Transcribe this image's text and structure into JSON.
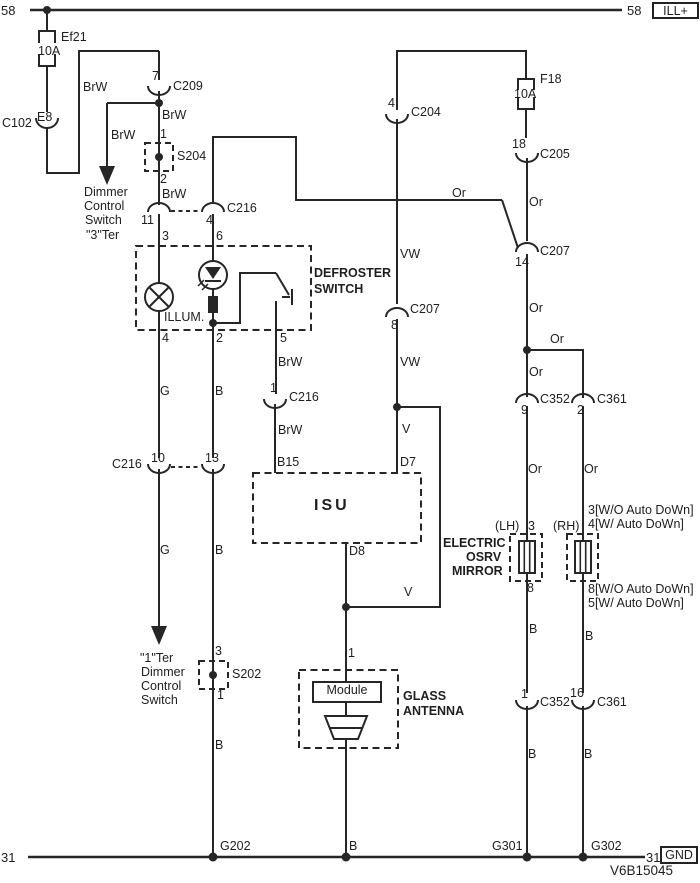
{
  "colors": {
    "line": "#262626",
    "text": "#1e1e1e",
    "background": "#ffffff"
  },
  "rails": {
    "top": {
      "left": "58",
      "right": "58",
      "tag": "ILL+"
    },
    "bottom": {
      "left": "31",
      "right": "31",
      "tag": "GND"
    }
  },
  "code": "V6B15045",
  "labels": [
    {
      "name": "fuse-ef21-name",
      "text": "Ef21",
      "x": 61,
      "y": 31
    },
    {
      "name": "fuse-ef21-rating",
      "text": "10A",
      "x": 38,
      "y": 45
    },
    {
      "name": "connector-c102-name",
      "text": "C102",
      "x": 2,
      "y": 117
    },
    {
      "name": "connector-c102-pin-e8",
      "text": "E8",
      "x": 37,
      "y": 111
    },
    {
      "name": "wire-brw-feed",
      "text": "BrW",
      "x": 83,
      "y": 81
    },
    {
      "name": "connector-c209-pin-7",
      "text": "7",
      "x": 152,
      "y": 70
    },
    {
      "name": "connector-c209-name",
      "text": "C209",
      "x": 173,
      "y": 80
    },
    {
      "name": "wire-brw-below-c209",
      "text": "BrW",
      "x": 162,
      "y": 109
    },
    {
      "name": "wire-brw-dimmer-branch",
      "text": "BrW",
      "x": 111,
      "y": 129
    },
    {
      "name": "splice-s204-pin-1",
      "text": "1",
      "x": 160,
      "y": 128
    },
    {
      "name": "splice-s204-name",
      "text": "S204",
      "x": 177,
      "y": 150
    },
    {
      "name": "splice-s204-pin-2",
      "text": "2",
      "x": 160,
      "y": 173
    },
    {
      "name": "wire-brw-above-c216",
      "text": "BrW",
      "x": 162,
      "y": 188
    },
    {
      "name": "dimmer-note-line-1",
      "text": "Dimmer",
      "x": 84,
      "y": 186
    },
    {
      "name": "dimmer-note-line-2",
      "text": "Control",
      "x": 84,
      "y": 200
    },
    {
      "name": "dimmer-note-line-3",
      "text": "Switch",
      "x": 85,
      "y": 214
    },
    {
      "name": "dimmer-note-line-4",
      "text": "\"3\"Ter",
      "x": 86,
      "y": 229
    },
    {
      "name": "connector-c216-top-pin-11",
      "text": "11",
      "x": 141,
      "y": 214
    },
    {
      "name": "connector-c216-top-pin-4",
      "text": "4",
      "x": 206,
      "y": 214
    },
    {
      "name": "connector-c216-top-name",
      "text": "C216",
      "x": 227,
      "y": 202
    },
    {
      "name": "defroster-pin-3",
      "text": "3",
      "x": 162,
      "y": 230
    },
    {
      "name": "defroster-pin-6",
      "text": "6",
      "x": 216,
      "y": 230
    },
    {
      "name": "defroster-name-line-1",
      "text": "DEFROSTER",
      "x": 314,
      "y": 267,
      "bold": true
    },
    {
      "name": "defroster-name-line-2",
      "text": "SWITCH",
      "x": 314,
      "y": 283,
      "bold": true
    },
    {
      "name": "defroster-illum-label",
      "text": "ILLUM.",
      "x": 164,
      "y": 311
    },
    {
      "name": "defroster-pin-4",
      "text": "4",
      "x": 162,
      "y": 332
    },
    {
      "name": "defroster-pin-2",
      "text": "2",
      "x": 216,
      "y": 332
    },
    {
      "name": "defroster-pin-5",
      "text": "5",
      "x": 280,
      "y": 332
    },
    {
      "name": "wire-g-upper",
      "text": "G",
      "x": 160,
      "y": 385
    },
    {
      "name": "wire-b-upper",
      "text": "B",
      "x": 215,
      "y": 385
    },
    {
      "name": "wire-brw-pin5",
      "text": "BrW",
      "x": 278,
      "y": 356
    },
    {
      "name": "connector-c216-mid-right-pin-1",
      "text": "1",
      "x": 270,
      "y": 382
    },
    {
      "name": "connector-c216-mid-right-name",
      "text": "C216",
      "x": 289,
      "y": 391
    },
    {
      "name": "wire-brw-to-isu",
      "text": "BrW",
      "x": 278,
      "y": 424
    },
    {
      "name": "isu-pin-b15",
      "text": "B15",
      "x": 277,
      "y": 456
    },
    {
      "name": "isu-pin-d7",
      "text": "D7",
      "x": 400,
      "y": 456
    },
    {
      "name": "wire-v-to-isu",
      "text": "V",
      "x": 402,
      "y": 423
    },
    {
      "name": "connector-c204-pin-4",
      "text": "4",
      "x": 388,
      "y": 97
    },
    {
      "name": "connector-c204-name",
      "text": "C204",
      "x": 411,
      "y": 106
    },
    {
      "name": "wire-vw-upper",
      "text": "VW",
      "x": 400,
      "y": 248
    },
    {
      "name": "connector-c207-mid-pin-8",
      "text": "8",
      "x": 391,
      "y": 319
    },
    {
      "name": "connector-c207-mid-name",
      "text": "C207",
      "x": 410,
      "y": 303
    },
    {
      "name": "wire-vw-lower",
      "text": "VW",
      "x": 400,
      "y": 356
    },
    {
      "name": "wire-or-top",
      "text": "Or",
      "x": 452,
      "y": 187
    },
    {
      "name": "fuse-f18-name",
      "text": "F18",
      "x": 540,
      "y": 73
    },
    {
      "name": "fuse-f18-rating",
      "text": "10A",
      "x": 514,
      "y": 88
    },
    {
      "name": "connector-c205-pin-18",
      "text": "18",
      "x": 512,
      "y": 138
    },
    {
      "name": "connector-c205-name",
      "text": "C205",
      "x": 540,
      "y": 148
    },
    {
      "name": "wire-or-above-c207",
      "text": "Or",
      "x": 529,
      "y": 196
    },
    {
      "name": "connector-c207-right-pin-14",
      "text": "14",
      "x": 515,
      "y": 256
    },
    {
      "name": "connector-c207-right-name",
      "text": "C207",
      "x": 540,
      "y": 245
    },
    {
      "name": "wire-or-below-c207",
      "text": "Or",
      "x": 529,
      "y": 302
    },
    {
      "name": "wire-or-branch",
      "text": "Or",
      "x": 550,
      "y": 333
    },
    {
      "name": "wire-or-above-c352",
      "text": "Or",
      "x": 529,
      "y": 366
    },
    {
      "name": "connector-c352-top-pin-9",
      "text": "9",
      "x": 521,
      "y": 404
    },
    {
      "name": "connector-c352-top-name",
      "text": "C352",
      "x": 540,
      "y": 393
    },
    {
      "name": "connector-c361-top-pin-2",
      "text": "2",
      "x": 577,
      "y": 404
    },
    {
      "name": "connector-c361-top-name",
      "text": "C361",
      "x": 597,
      "y": 393
    },
    {
      "name": "wire-or-lh",
      "text": "Or",
      "x": 528,
      "y": 463
    },
    {
      "name": "wire-or-rh",
      "text": "Or",
      "x": 584,
      "y": 463
    },
    {
      "name": "mirror-rh-note-line-1",
      "text": "3[W/O Auto DoWn]",
      "x": 588,
      "y": 504
    },
    {
      "name": "mirror-rh-note-line-2",
      "text": "4[W/ Auto DoWn]",
      "x": 588,
      "y": 518
    },
    {
      "name": "mirror-lh-tag",
      "text": "(LH)",
      "x": 495,
      "y": 520
    },
    {
      "name": "mirror-lh-pin-3",
      "text": "3",
      "x": 528,
      "y": 520
    },
    {
      "name": "mirror-rh-tag",
      "text": "(RH)",
      "x": 553,
      "y": 520
    },
    {
      "name": "mirror-name-line-1",
      "text": "ELECTRIC",
      "x": 443,
      "y": 537,
      "bold": true
    },
    {
      "name": "mirror-name-line-2",
      "text": "OSRV",
      "x": 466,
      "y": 551,
      "bold": true
    },
    {
      "name": "mirror-name-line-3",
      "text": "MIRROR",
      "x": 452,
      "y": 565,
      "bold": true
    },
    {
      "name": "mirror-lh-pin-8",
      "text": "8",
      "x": 527,
      "y": 582
    },
    {
      "name": "mirror-rh-note-line-3",
      "text": "8[W/O Auto DoWn]",
      "x": 588,
      "y": 583
    },
    {
      "name": "mirror-rh-note-line-4",
      "text": "5[W/ Auto DoWn]",
      "x": 588,
      "y": 597
    },
    {
      "name": "wire-b-lh-upper",
      "text": "B",
      "x": 529,
      "y": 623
    },
    {
      "name": "wire-b-rh-upper",
      "text": "B",
      "x": 585,
      "y": 630
    },
    {
      "name": "isu-name",
      "text": "ISU",
      "x": 314,
      "y": 498,
      "bold": true,
      "size": 16,
      "ls": 3
    },
    {
      "name": "isu-pin-d8",
      "text": "D8",
      "x": 349,
      "y": 545
    },
    {
      "name": "wire-v-antenna",
      "text": "V",
      "x": 404,
      "y": 586
    },
    {
      "name": "antenna-pin-1",
      "text": "1",
      "x": 348,
      "y": 647
    },
    {
      "name": "antenna-module-label",
      "text": "Module",
      "x": 313,
      "y": 684,
      "w": 68,
      "center": true
    },
    {
      "name": "antenna-name-line-1",
      "text": "GLASS",
      "x": 403,
      "y": 690,
      "bold": true
    },
    {
      "name": "antenna-name-line-2",
      "text": "ANTENNA",
      "x": 403,
      "y": 705,
      "bold": true
    },
    {
      "name": "ter-note-line-1",
      "text": "\"1\"Ter",
      "x": 140,
      "y": 652
    },
    {
      "name": "ter-note-line-2",
      "text": "Dimmer",
      "x": 141,
      "y": 666
    },
    {
      "name": "ter-note-line-3",
      "text": "Control",
      "x": 141,
      "y": 680
    },
    {
      "name": "ter-note-line-4",
      "text": "Switch",
      "x": 141,
      "y": 694
    },
    {
      "name": "splice-s202-pin-3",
      "text": "3",
      "x": 215,
      "y": 645
    },
    {
      "name": "splice-s202-name",
      "text": "S202",
      "x": 232,
      "y": 668
    },
    {
      "name": "splice-s202-pin-1",
      "text": "1",
      "x": 217,
      "y": 689
    },
    {
      "name": "wire-g-lower",
      "text": "G",
      "x": 160,
      "y": 544
    },
    {
      "name": "wire-b-mid",
      "text": "B",
      "x": 215,
      "y": 544
    },
    {
      "name": "connector-c216-mid-name",
      "text": "C216",
      "x": 112,
      "y": 458
    },
    {
      "name": "connector-c216-mid-pin-10",
      "text": "10",
      "x": 151,
      "y": 452
    },
    {
      "name": "connector-c216-mid-pin-13",
      "text": "13",
      "x": 205,
      "y": 452
    },
    {
      "name": "wire-b-lower",
      "text": "B",
      "x": 215,
      "y": 739
    },
    {
      "name": "connector-c352-bottom-pin-1",
      "text": "1",
      "x": 521,
      "y": 688
    },
    {
      "name": "connector-c352-bottom-name",
      "text": "C352",
      "x": 540,
      "y": 696
    },
    {
      "name": "connector-c361-bottom-pin-16",
      "text": "16",
      "x": 570,
      "y": 687
    },
    {
      "name": "connector-c361-bottom-name",
      "text": "C361",
      "x": 597,
      "y": 696
    },
    {
      "name": "wire-b-lh-lower",
      "text": "B",
      "x": 528,
      "y": 748
    },
    {
      "name": "wire-b-rh-lower",
      "text": "B",
      "x": 584,
      "y": 748
    },
    {
      "name": "ground-g202-name",
      "text": "G202",
      "x": 220,
      "y": 840
    },
    {
      "name": "wire-b-antenna-ground",
      "text": "B",
      "x": 349,
      "y": 840
    },
    {
      "name": "ground-g301-name",
      "text": "G301",
      "x": 492,
      "y": 840
    },
    {
      "name": "ground-g302-name",
      "text": "G302",
      "x": 591,
      "y": 840
    }
  ]
}
